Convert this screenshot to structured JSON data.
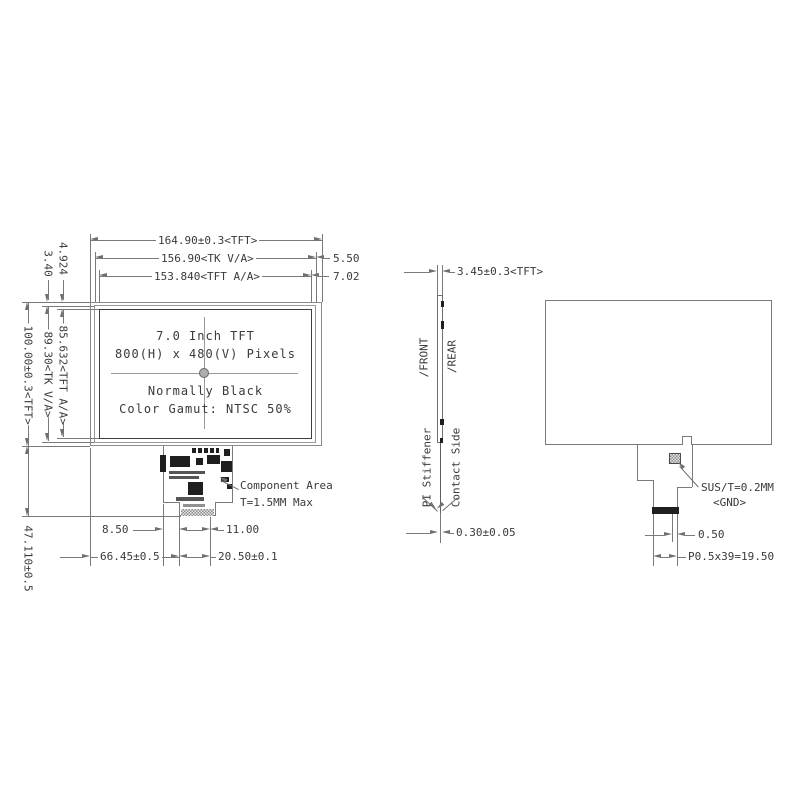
{
  "front": {
    "info": [
      "7.0 Inch TFT",
      "800(H) x 480(V) Pixels",
      "Normally Black",
      "Color Gamut: NTSC 50%"
    ],
    "dims_top": {
      "width_tft": "164.90±0.3<TFT>",
      "width_tk": "156.90<TK V/A>",
      "width_aa": "153.840<TFT A/A>",
      "right_offset_tk": "5.50",
      "right_offset_aa": "7.02"
    },
    "dims_left": {
      "top_offset_aa": "4.924",
      "top_offset_tk": "3.40",
      "height_aa": "85.632<TFT A/A>",
      "height_tk": "89.30<TK V/A>",
      "height_tft": "100.00±0.3<TFT>",
      "tail_length": "47.110±0.5"
    },
    "dims_bottom": {
      "d850": "8.50",
      "d1100": "11.00",
      "d6645": "66.45±0.5",
      "d2050": "20.50±0.1"
    },
    "component_area": {
      "line1": "Component Area",
      "line2": "T=1.5MM Max"
    }
  },
  "side": {
    "thickness": "3.45±0.3<TFT>",
    "front_label": "/FRONT",
    "rear_label": "/REAR",
    "stiffener_label": "PI Stiffener",
    "contact_label": "Contact Side",
    "fpc_thickness": "0.30±0.05"
  },
  "rear": {
    "sus_label": "SUS/T=0.2MM",
    "gnd_label": "<GND>",
    "margin": "0.50",
    "pitch": "P0.5x39=19.50"
  },
  "colors": {
    "line": "#7a7a7a",
    "text": "#3a3a3a",
    "component": "#1f1f1f"
  }
}
